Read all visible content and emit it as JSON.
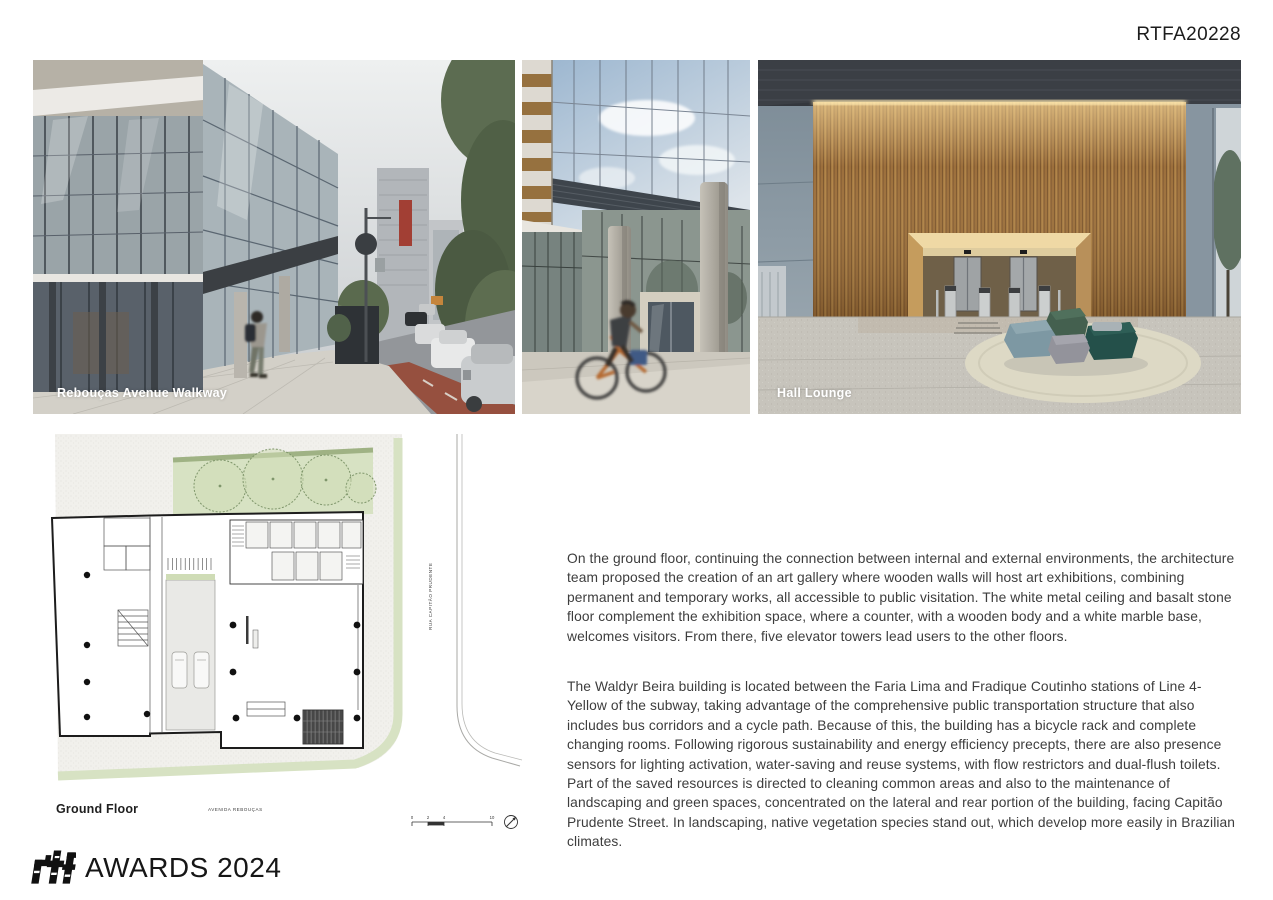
{
  "header": {
    "project_code": "RTFA20228"
  },
  "photos": {
    "street": {
      "caption": "Rebouças Avenue Walkway"
    },
    "entrance": {
      "caption": ""
    },
    "hall": {
      "caption": "Hall Lounge"
    }
  },
  "floor_plan": {
    "title": "Ground Floor",
    "street_bottom_label": "AVENIDA REBOUÇAS",
    "street_right_label": "RUA CAPITÃO PRUDENTE",
    "scale_ticks": [
      "0",
      "2",
      "4",
      "10"
    ]
  },
  "article": {
    "paragraph1": "On the ground floor, continuing the connection between internal and external environments, the architecture team proposed the creation of an art gallery where wooden walls will host art exhibitions, combining permanent and temporary works, all accessible to public visitation. The white metal ceiling and basalt stone floor complement the exhibition space, where a counter, with a wooden body and a white marble base, welcomes visitors. From there, five elevator towers lead users to the other floors.",
    "paragraph2": "The Waldyr Beira building is located between the Faria Lima and Fradique Coutinho stations of Line 4-Yellow of the subway, taking advantage of the comprehensive public transportation structure that also includes bus corridors and a cycle path. Because of this, the building has a bicycle rack and complete changing rooms. Following rigorous sustainability and energy efficiency precepts, there are also presence sensors for lighting activation, water-saving and reuse systems, with flow restrictors and dual-flush toilets. Part of the saved resources is directed to cleaning common areas and also to the maintenance of landscaping and green spaces, concentrated on the lateral and rear portion of the building, facing Capitão Prudente Street. In landscaping, native vegetation species stand out, which develop more easily in Brazilian climates."
  },
  "footer": {
    "awards_wordmark": "AWARDS 2024"
  },
  "colors": {
    "landscape_green": "#d7e2c3",
    "wood": "#9c6f3c",
    "teal_ottoman": "#24504a",
    "page_background": "#ffffff",
    "body_text": "#3d3d3d"
  }
}
